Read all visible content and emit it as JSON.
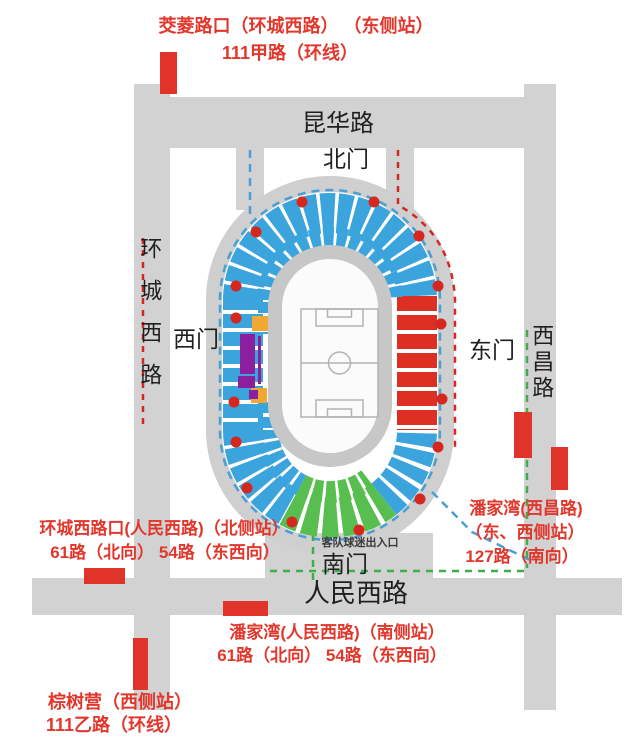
{
  "title": "体育场周边公交站点示意图",
  "roads": {
    "kunhua": "昆华路",
    "huancheng_west": "环城西路",
    "xichang": "西昌路",
    "renmin_west": "人民西路"
  },
  "gates": {
    "north": "北门",
    "west": "西门",
    "east": "东门",
    "south": "南门"
  },
  "stadium": {
    "away_fans_entrance": "客队球迷出入口"
  },
  "stations": {
    "jiaoling": {
      "name": "茭菱路口（环城西路） （东侧站）",
      "lines": "111甲路（环线）"
    },
    "huancheng_xilukou": {
      "name": "环城西路口(人民西路)（北侧站）",
      "lines": "61路（北向） 54路（东西向）"
    },
    "panjiawan_xichang": {
      "name": "潘家湾(西昌路)",
      "side": "（东、西侧站）",
      "lines": "127路（南向）"
    },
    "panjiawan_renmin": {
      "name": "潘家湾(人民西路)（南侧站）",
      "lines": "61路（北向） 54路（东西向）"
    },
    "zongshuying": {
      "name": "棕树营（西侧站）",
      "lines": "111乙路（环线）"
    }
  },
  "colors": {
    "road-gray": "#d2d2d2",
    "ring-gray": "#cfcfcf",
    "track-gray": "#c7c7c7",
    "field-white": "#fbfbfb",
    "pitch-line": "#b3b3b3",
    "stand-blue": "#3ba4dc",
    "stand-red": "#dd2f23",
    "stand-green": "#58be50",
    "accent-orange": "#f0a832",
    "accent-purple": "#8b1f9e",
    "dot-red": "#d6271e",
    "marker-red": "#e0342b",
    "route-blue": "#4a9fd4",
    "route-red": "#d6271e",
    "route-green": "#3fae4a",
    "text-red": "#e2372c",
    "text-black": "#1f1f1f"
  }
}
